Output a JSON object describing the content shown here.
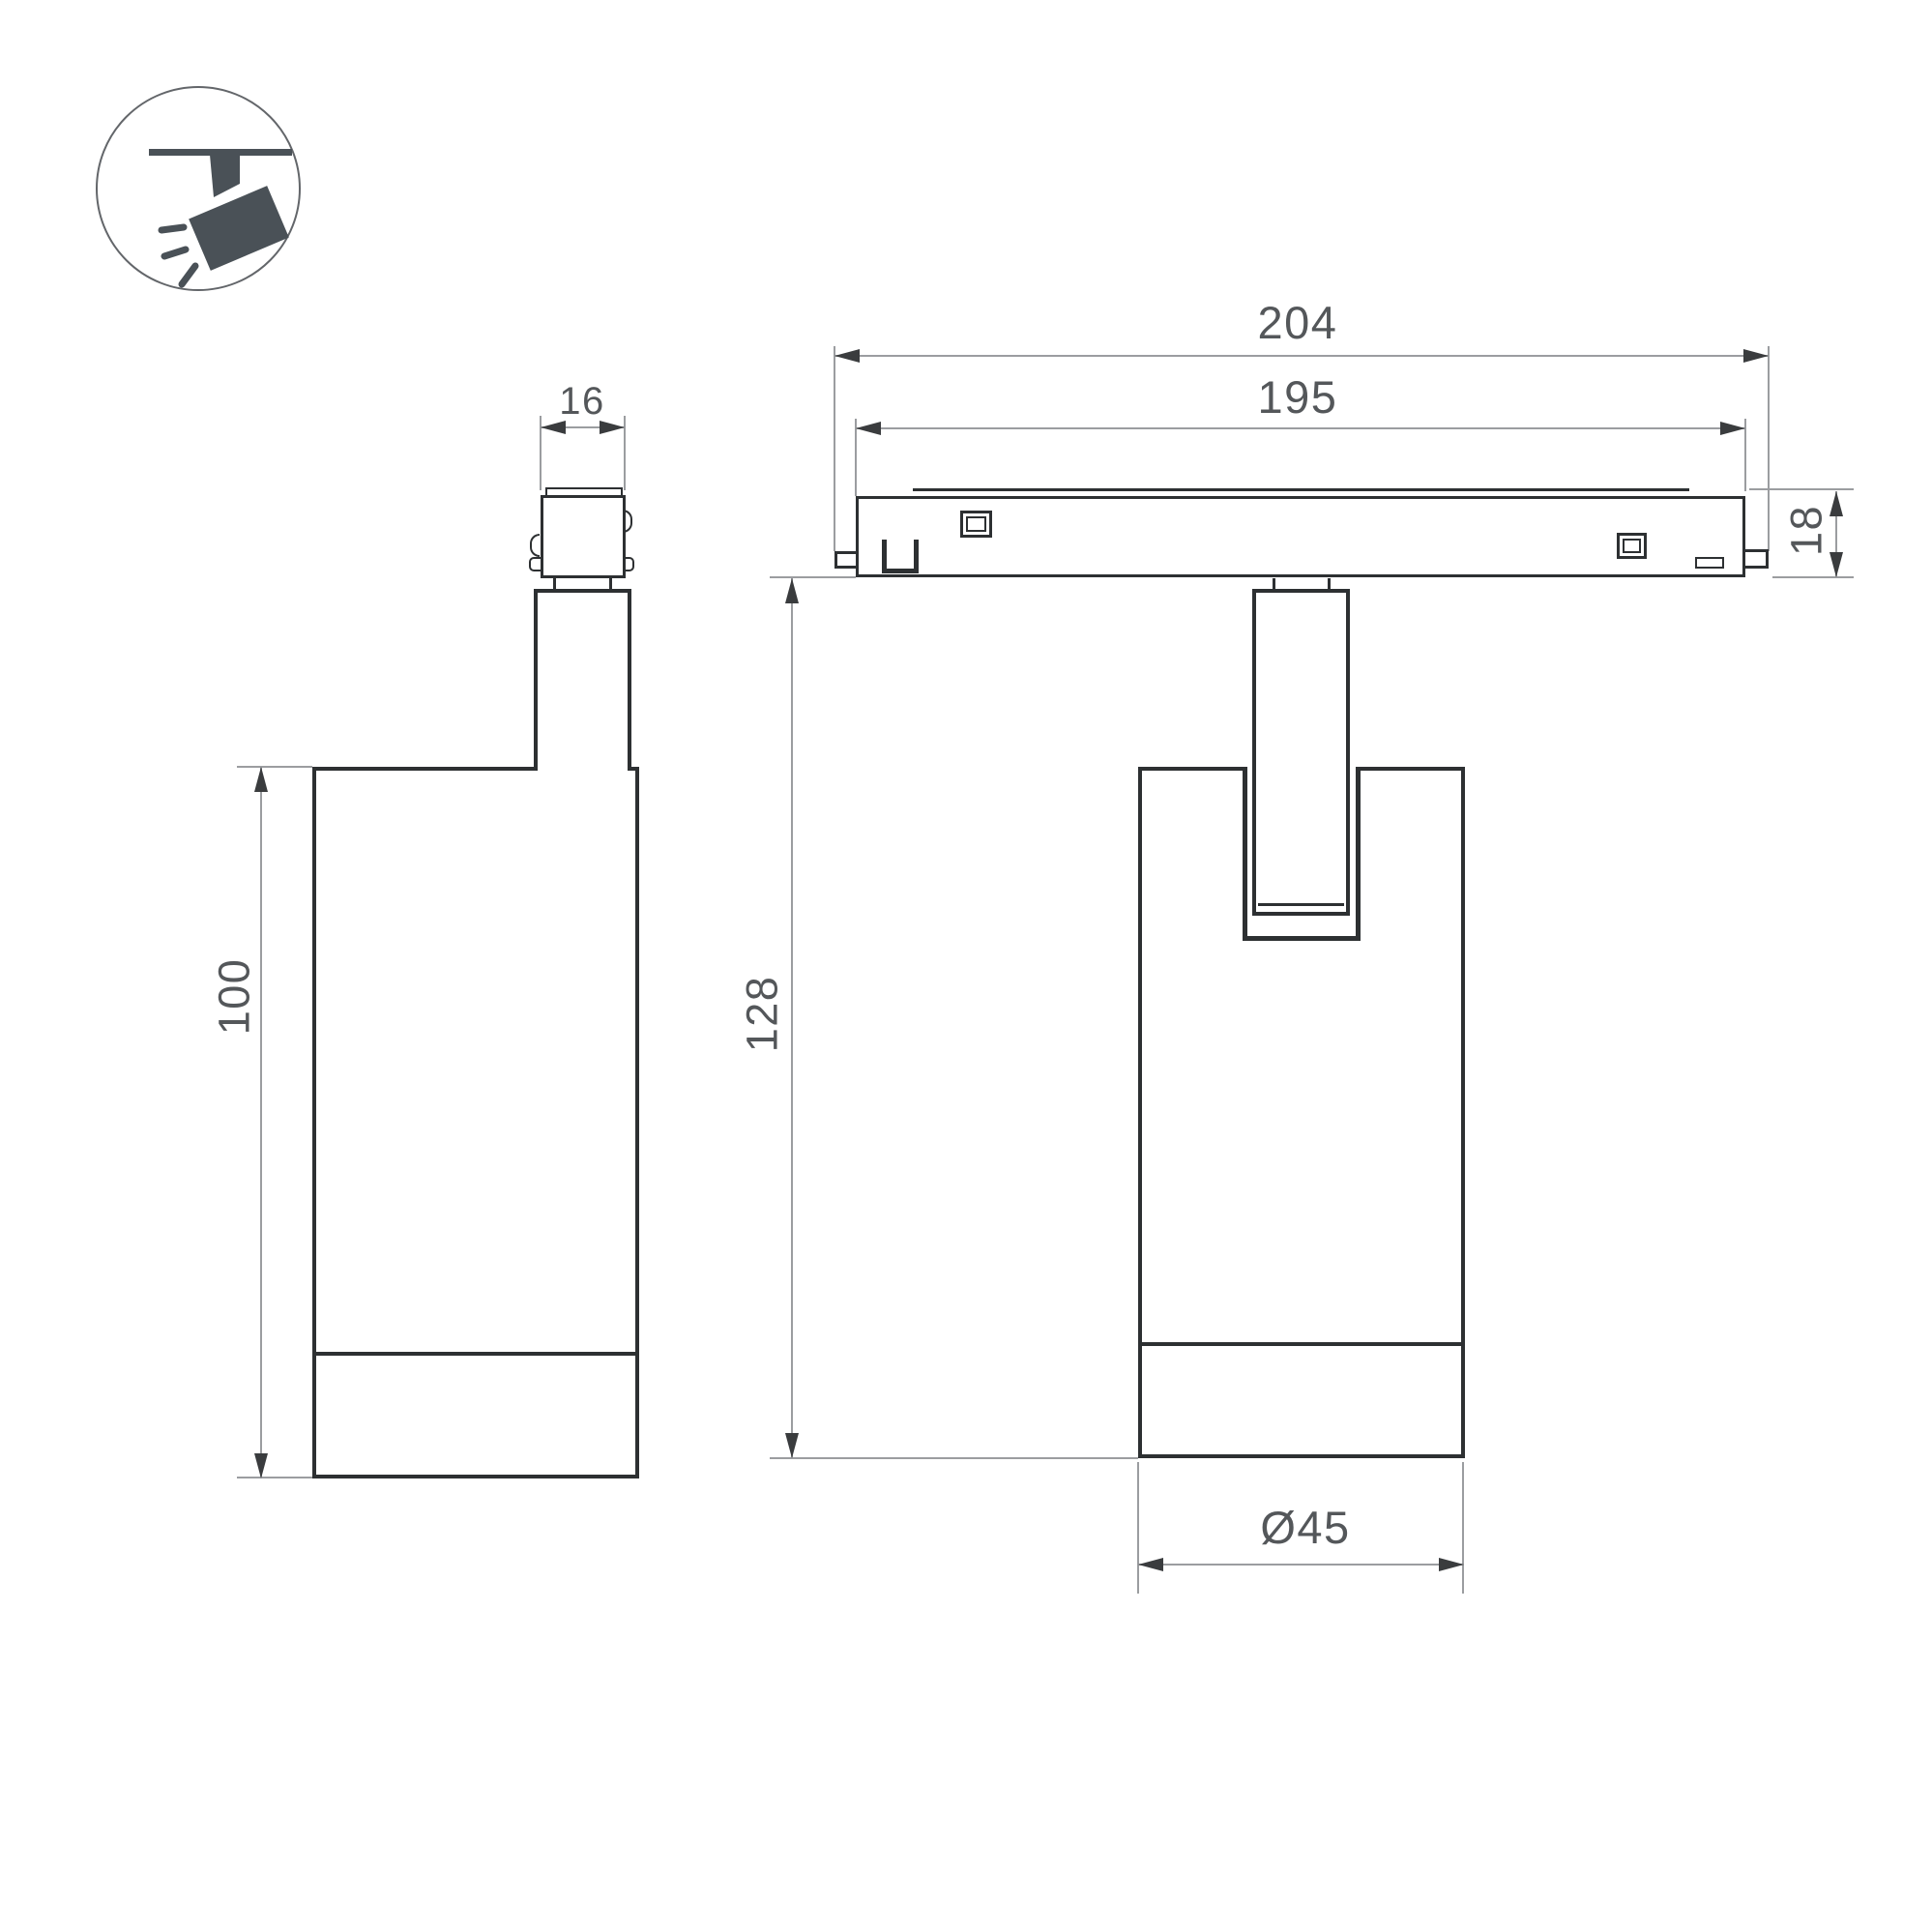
{
  "title": "Track spotlight dimension drawing",
  "dimensions": {
    "track_length_outer": "204",
    "track_length_inner": "195",
    "track_height": "18",
    "adapter_width": "16",
    "body_height": "100",
    "overall_height": "128",
    "body_diameter": "Ø45"
  },
  "icon": {
    "name": "track-spotlight-pictogram",
    "fill": "#4a5157",
    "circle_stroke": "#63666a"
  },
  "colors": {
    "outline": "#2d3032",
    "dimension_line": "#9b9da0",
    "arrowhead": "#3a3c3e",
    "dimension_text": "#54575a",
    "background": "#ffffff"
  }
}
